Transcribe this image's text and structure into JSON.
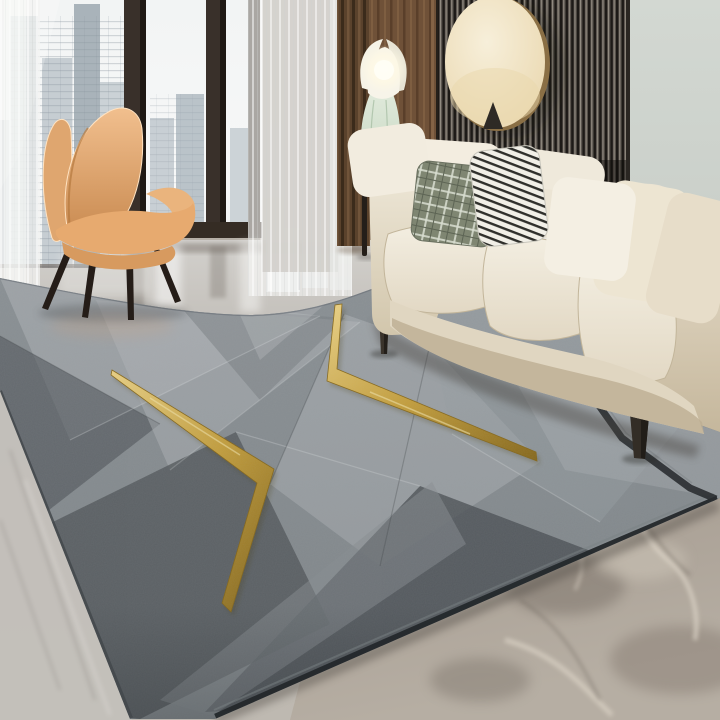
{
  "palette": {
    "sky": "#f2f4f4",
    "building_a": "#b4bec5",
    "building_b": "#c6cdd2",
    "building_c": "#a9b3ba",
    "building_d": "#cbd2d6",
    "window_frame": "#39302a",
    "sheer_curtain": "#f3f4f2",
    "brown_curtain": "#5a422c",
    "wood_panel": "#6f5138",
    "slat_base": "#56504a",
    "slat_dark": "#1d1a17",
    "slat_light": "#9a948a",
    "wall_sage": "#d3d8d2",
    "disc_cream": "#f7efda",
    "disc_rim": "#8a6f45",
    "lamp_mint": "#c8d8c3",
    "lamp_white": "#f6f3e7",
    "lamp_glow": "#fffdf2",
    "chair_orange": "#d99a63",
    "chair_light": "#f1bf8e",
    "chair_dark": "#c8894f",
    "chair_leg": "#251d18",
    "sofa_cream": "#f3eee1",
    "sofa_mid": "#e2d8c4",
    "sofa_dark": "#c5b79c",
    "pillow_sage": "#7f8672",
    "pillow_grid_light": "#d9ddd0",
    "pillow_stripe_dark": "#2f2f2b",
    "pillow_white": "#f2ecdf",
    "floor_light": "#d2d0cc",
    "floor_mid": "#b5b0a9",
    "marble_warm": "#a69c91",
    "marble_vein": "#dbd3c6",
    "marble_dark": "#6e665d",
    "rug_base": "#8a9094",
    "rug_light": "#b1b6b9",
    "rug_dark": "#50555a",
    "rug_edge": "#24282b",
    "gold": "#c9a23d",
    "gold_light": "#eed486",
    "gold_dark": "#8a6a1a"
  },
  "scene_objects": [
    "city-window",
    "sheer-curtains",
    "brown-curtain",
    "accent-chair",
    "wood-wall-panel",
    "slat-wall-panel",
    "round-wall-decor",
    "floor-lamp",
    "cream-sofa",
    "throw-pillows",
    "marble-floor",
    "geometric-area-rug",
    "gold-accent-lines"
  ]
}
